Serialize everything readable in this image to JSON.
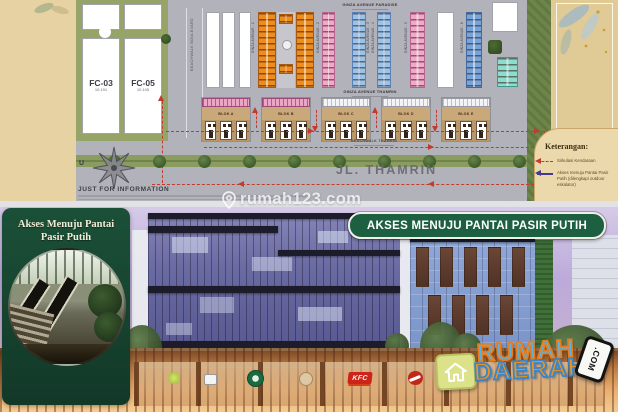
{
  "watermark": {
    "text": "rumah123.com"
  },
  "siteplan": {
    "left_blocks": [
      {
        "name": "FC-03",
        "area": "10.191"
      },
      {
        "name": "FC-05",
        "area": "10.105"
      }
    ],
    "roads": {
      "beachwalk_boulevard": "BEACHWALK BOULEVARD",
      "beachwalk_thamrin": "BEACHWALK THAMRIN",
      "jl_thamrin": "JL. THAMRIN"
    },
    "clusters": {
      "paradise_title": "GINZA AVENUE PARADISE",
      "thamrin_title": "GINZA AVENUE THAMRIN",
      "avenues": [
        "GINZA AVENUE - 1",
        "GINZA AVENUE - 2",
        "GINZA AVENUE - 3",
        "GINZA AVENUE - 4",
        "GINZA AVENUE - 5",
        "GINZA AVENUE - 6"
      ]
    },
    "shop_blocks": [
      "BLOK A",
      "BLOK B",
      "BLOK C",
      "BLOK D",
      "BLOK E"
    ],
    "compass_north": "U",
    "info_note": "JUST FOR INFORMATION",
    "legend": {
      "title": "Keterangan:",
      "items": [
        {
          "label": "Sirkulasi Kendaraan",
          "color": "#c23b2e",
          "style": "dashed"
        },
        {
          "label": "Akses menuju Pantai Pasir Putih (dilengkapi outdoor eskalator)",
          "color": "#473a8e",
          "style": "solid"
        }
      ]
    }
  },
  "render": {
    "inset_title": "Akses Menuju Pantai Pasir Putih",
    "banner": "AKSES MENUJU PANTAI PASIR PUTIH",
    "site_logo": {
      "line1": "RUMAH",
      "line2": "DAERAH",
      "badge": ".COM"
    },
    "kfc_label": "KFC",
    "storefront_logos": [
      "lime-circle-logo",
      "white-square-logo",
      "starbucks-logo",
      "coffee-logo",
      "kfc-logo",
      "pizza-hut-logo"
    ],
    "colors": {
      "panel_green": "#174632",
      "banner_green": "#1d5f41",
      "rumah_blue": "#55b4e8",
      "daerah_orange": "#f0921e",
      "sky": "#b7a6d8"
    }
  }
}
